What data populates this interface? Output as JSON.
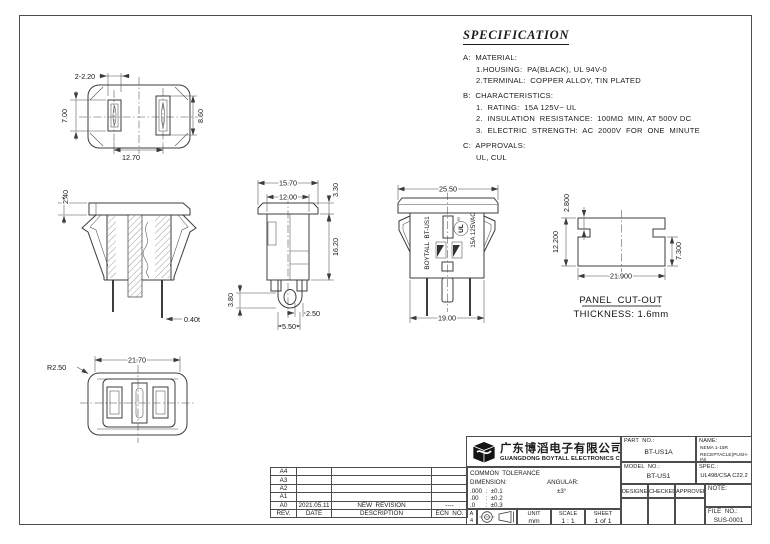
{
  "spec": {
    "title": "SPECIFICATION",
    "sections": [
      {
        "heading": "A:  MATERIAL:",
        "items": [
          "1.HOUSING:  PA(BLACK), UL 94V-0",
          "2.TERMINAL:  COPPER ALLOY, TIN PLATED"
        ]
      },
      {
        "heading": "B:  CHARACTERISTICS:",
        "items": [
          "1.  RATING:  15A 125V~ UL",
          "2.  INSULATION  RESISTANCE:  100MΩ  MIN, AT 500V DC",
          "3.  ELECTRIC  STRENGTH:  AC  2000V  FOR  ONE  MINUTE"
        ]
      },
      {
        "heading": "C:  APPROVALS:",
        "items": [
          "UL, CUL"
        ]
      }
    ]
  },
  "views": {
    "front_face": {
      "dim_slot_width": "2-2.20",
      "dim_left_height": "7.00",
      "dim_right_height": "8.60",
      "dim_pitch": "12.70"
    },
    "section": {
      "dim_flange": "2.40",
      "dim_thickness": "0.40t"
    },
    "side": {
      "dim_flange_width": "15.70",
      "dim_inner_width": "12.00",
      "dim_flange_height": "3.30",
      "dim_body_height": "16.20",
      "dim_tab_height": "3.80",
      "dim_tab_dia": "2.50",
      "dim_tab_width": "5.50"
    },
    "rear": {
      "dim_flange_width": "25.50",
      "dim_body_width": "19.00",
      "marking_brand": "BOYTALL  BT-US1",
      "marking_rating": "15A 125VAC",
      "marking_ul": "UL",
      "marking_ul_sub": "us"
    },
    "panel_cutout": {
      "dim_notch_depth": "2.800",
      "dim_height": "12.200",
      "dim_side_height": "7.300",
      "dim_width": "21.900",
      "label": "PANEL  CUT-OUT",
      "thickness": "THICKNESS: 1.6mm"
    },
    "bottom": {
      "dim_width": "21.70",
      "dim_corner_radius": "R2.50"
    }
  },
  "revision_table": {
    "rows": [
      {
        "rev": "A4",
        "date": "",
        "description": "",
        "ecn": ""
      },
      {
        "rev": "A3",
        "date": "",
        "description": "",
        "ecn": ""
      },
      {
        "rev": "A2",
        "date": "",
        "description": "",
        "ecn": ""
      },
      {
        "rev": "A1",
        "date": "",
        "description": "",
        "ecn": ""
      },
      {
        "rev": "A0",
        "date": "2021.05.11",
        "description": "NEW  REVISION",
        "ecn": "----"
      }
    ],
    "header": {
      "rev": "REV.",
      "date": "DATE",
      "description": "DESCRIPTION",
      "ecn": "ECN  NO."
    }
  },
  "title_block": {
    "company_cn": "广东博滔电子有限公司",
    "company_en": "GUANGDONG BOYTALL ELECTRONICS CO.,LTD",
    "tolerance": {
      "title": "COMMON  TOLERANCE",
      "dimension_label": "DIMENSION:",
      "angular_label": "ANGULAR:",
      "angular_value": "±3°",
      "rows": [
        ".000  :  ±0.1",
        ".00    :  ±0.2",
        ".0      :  ±0.3"
      ]
    },
    "paper": {
      "line1": "A",
      "line2": "4"
    },
    "unit": {
      "label": "UNIT",
      "value": "mm"
    },
    "scale": {
      "label": "SCALE",
      "value": "1 : 1"
    },
    "sheet": {
      "label": "SHEET",
      "value": "1 of 1"
    },
    "part_no": {
      "label": "PART  NO.:",
      "value": "BT-US1A"
    },
    "name": {
      "label": "NAME:",
      "line1": "NEMA 1-15R",
      "line2": "RECEPTACLE(PUSH-IN)"
    },
    "model_no": {
      "label": "MODEL  NO.:",
      "value": "BT-US1"
    },
    "spec": {
      "label": "SPEC.:",
      "value": "UL498/CSA C22.2"
    },
    "designer": "DESIGNER",
    "checked": "CHECKED",
    "approved": "APPROVED",
    "note_label": "NOTE:",
    "file_no": {
      "label": "FILE  NO.:",
      "value": "SUS-0001"
    }
  }
}
